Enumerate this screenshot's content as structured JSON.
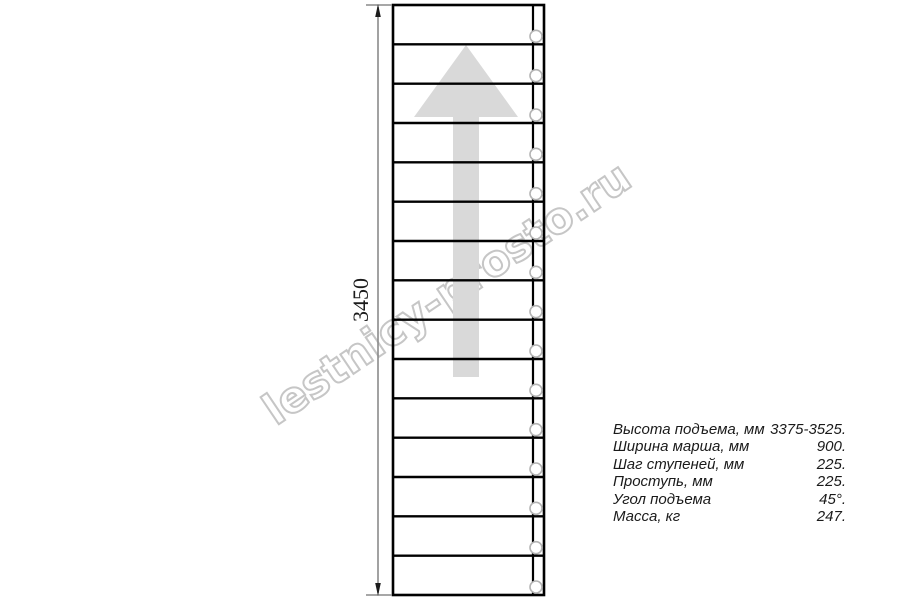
{
  "watermark": {
    "text": "lestnicy-prosto.ru",
    "stroke_color": "#c6c6c6"
  },
  "drawing": {
    "dimension": {
      "label": "3450",
      "line_color": "#8a8a8a",
      "arrow_color": "#1b1b1b"
    },
    "stairs": {
      "treads": 15,
      "bolt_circles": 15,
      "line_color": "#000000",
      "circle_color": "#b4b4b4",
      "circle_fill": "#ffffff"
    },
    "arrow": {
      "color": "#d9d9d9"
    }
  },
  "specs": {
    "rows": [
      {
        "label": "Высота подъема, мм",
        "value": "3375-3525."
      },
      {
        "label": "Ширина марша, мм",
        "value": "900."
      },
      {
        "label": "Шаг ступеней, мм",
        "value": "225."
      },
      {
        "label": "Проступь, мм",
        "value": "225."
      },
      {
        "label": "Угол подъема",
        "value": "45°."
      },
      {
        "label": "Масса, кг",
        "value": "247."
      }
    ]
  }
}
